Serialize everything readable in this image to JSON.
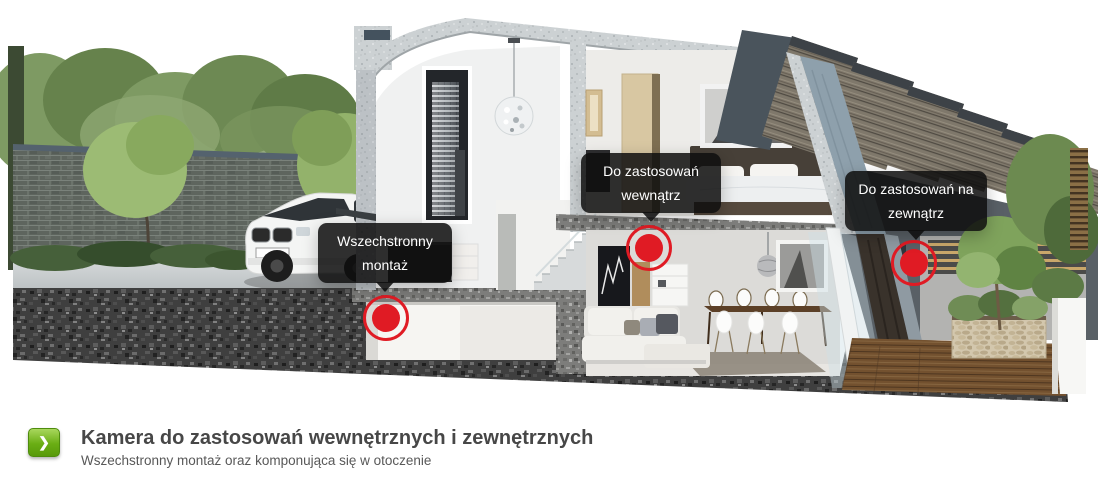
{
  "scene": {
    "alt": "Cutaway render of a modern two-storey house with marked camera placement points",
    "hotspots": [
      {
        "id": "mount",
        "label": "Wszechstronny montaż",
        "lines": [
          "Wszechstronny",
          "montaż"
        ]
      },
      {
        "id": "indoor",
        "label": "Do zastosowań wewnątrz",
        "lines": [
          "Do zastosowań",
          "wewnątrz"
        ]
      },
      {
        "id": "outdoor",
        "label": "Do zastosowań na zewnątrz",
        "lines": [
          "Do zastosowań na",
          "zewnątrz"
        ]
      }
    ]
  },
  "caption": {
    "title": "Kamera do zastosowań wewnętrznych i zewnętrznych",
    "subtitle": "Wszechstronny montaż oraz komponująca się w otoczenie"
  },
  "icons": {
    "chevron_right": "❯"
  },
  "colors": {
    "marker_red": "#e01b24",
    "tooltip_bg": "#0e0e0e",
    "button_green_top": "#a9d75d",
    "button_green_bottom": "#589a0b",
    "title_text": "#474747",
    "subtitle_text": "#585858"
  }
}
